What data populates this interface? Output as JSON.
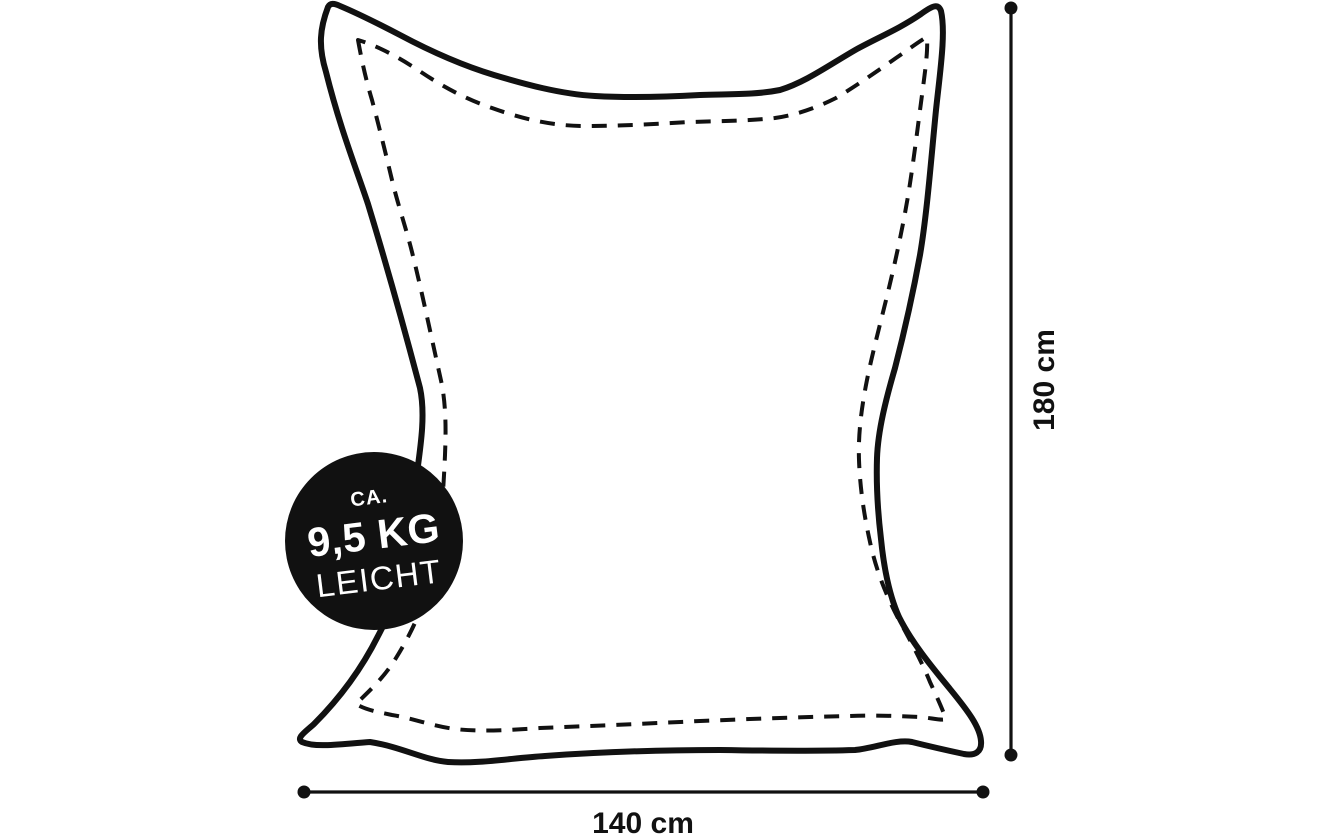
{
  "badge": {
    "prefix": "CA.",
    "weight": "9,5 KG",
    "suffix": "LEICHT"
  },
  "dimensions": {
    "height": "180 cm",
    "width": "140 cm"
  },
  "colors": {
    "ink": "#111111",
    "background": "#ffffff",
    "badge_background": "#111111",
    "badge_text": "#ffffff"
  }
}
